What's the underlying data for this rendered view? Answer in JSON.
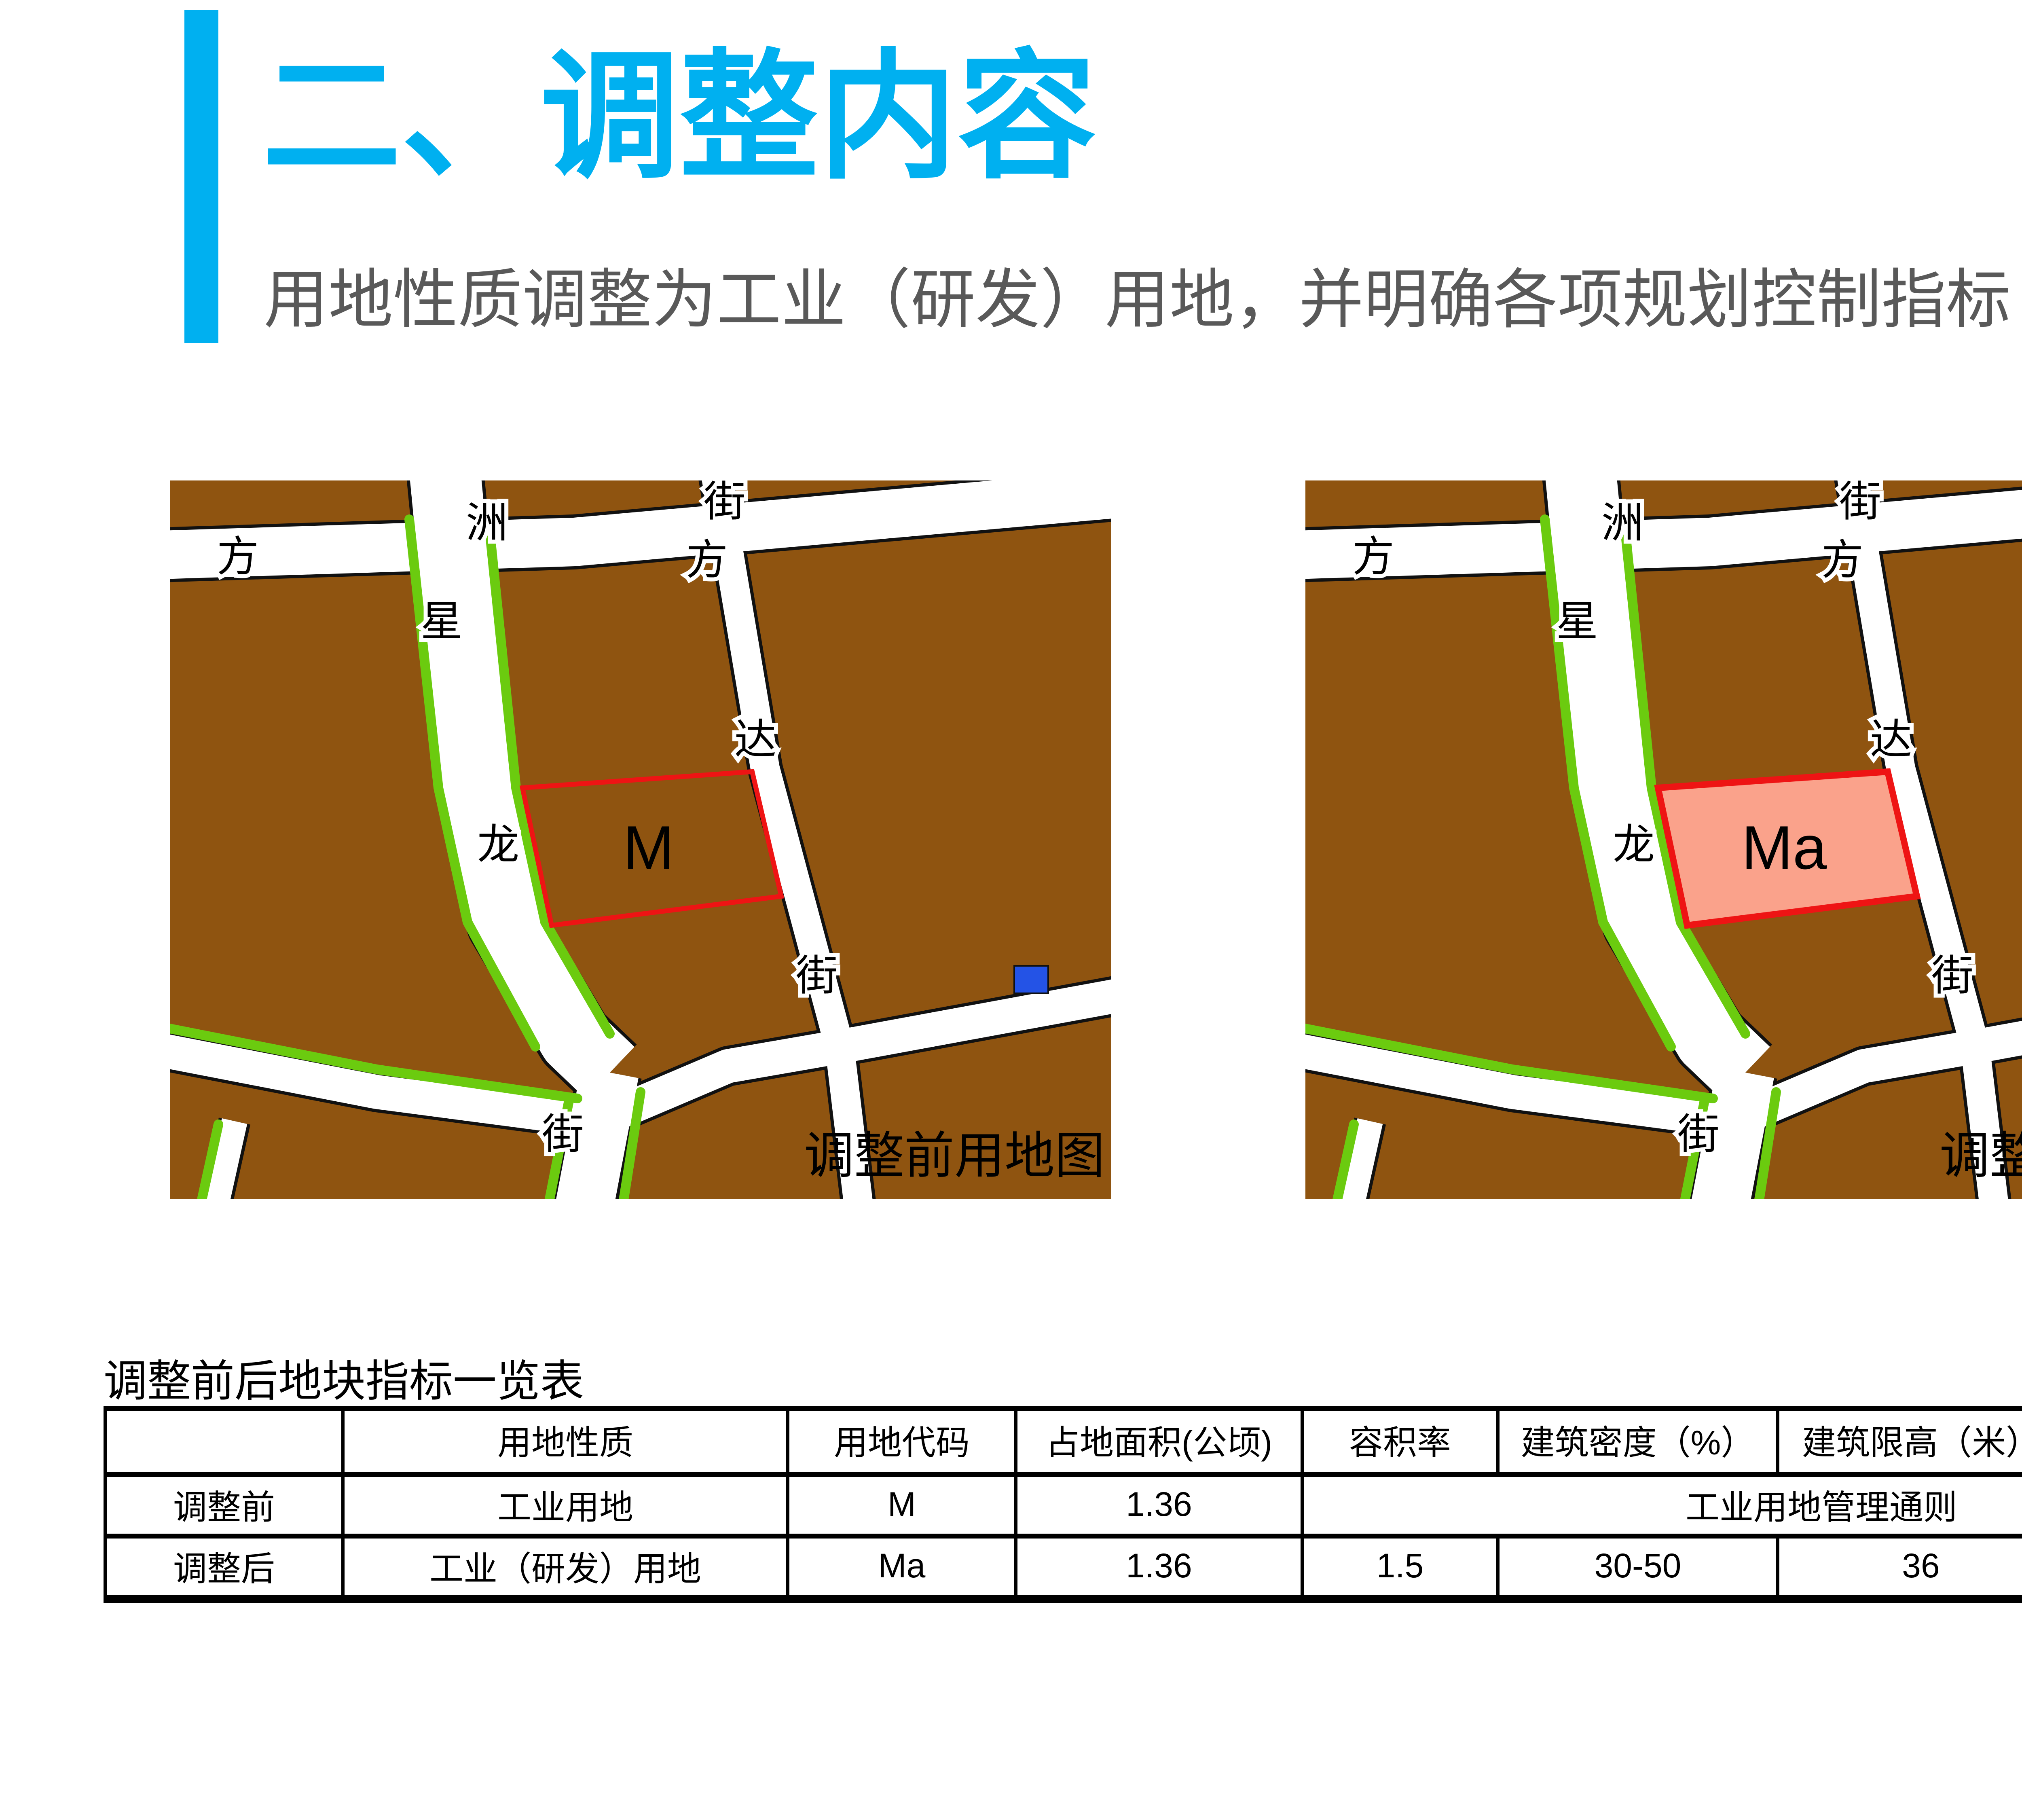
{
  "header": {
    "title": "二、调整内容",
    "subtitle": "用地性质调整为工业（研发）用地，并明确各项规划控制指标",
    "accent_color": "#00B0F0",
    "subtitle_color": "#595959"
  },
  "maps": {
    "left": {
      "caption": "调整前用地图",
      "plot_label": "M"
    },
    "right": {
      "caption": "调整后用地图",
      "plot_label": "Ma"
    },
    "street_chars": {
      "fang1": "方",
      "zhou": "洲",
      "jie1": "街",
      "fang2": "方",
      "da": "达",
      "jie2": "街",
      "xing": "星",
      "long": "龙",
      "jie3": "街"
    },
    "colors": {
      "parcel_brown": "#8F5410",
      "street_white": "#FFFFFF",
      "street_edge": "#111111",
      "green_strip": "#6BCB0F",
      "plot_outline_red": "#EE1414",
      "plot_fill_pink": "#FAA28B",
      "water_blue": "#2453E6"
    }
  },
  "table": {
    "title": "调整前后地块指标一览表",
    "columns": [
      "",
      "用地性质",
      "用地代码",
      "占地面积(公顷)",
      "容积率",
      "建筑密度（%）",
      "建筑限高（米）",
      "绿化率（%）"
    ],
    "rows": [
      {
        "label": "调整前",
        "values": [
          "工业用地",
          "M",
          "1.36"
        ],
        "merged": "工业用地管理通则"
      },
      {
        "label": "调整后",
        "values": [
          "工业（研发）用地",
          "Ma",
          "1.36",
          "1.5",
          "30-50",
          "36",
          "30"
        ]
      }
    ],
    "highlight_color": "#FF0000"
  }
}
